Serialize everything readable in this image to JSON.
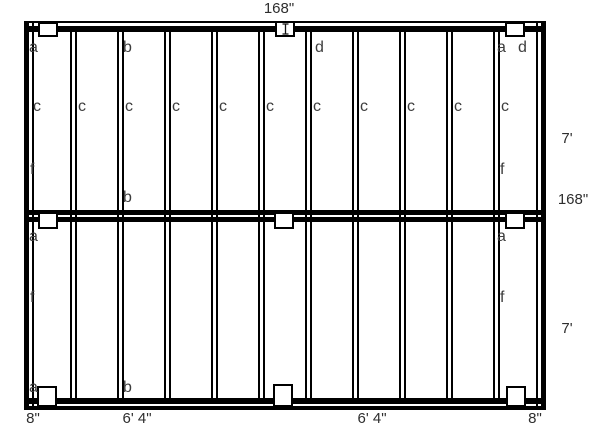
{
  "diagram": {
    "title": "deck framing plan",
    "colors": {
      "background": "#ffffff",
      "line": "#000000",
      "text": "#3d3d3d"
    },
    "frame": {
      "x": 24,
      "y": 21,
      "w": 522,
      "h": 389
    },
    "beams": {
      "top-beam-band": {
        "x": 24,
        "y": 26,
        "w": 522,
        "h": 6
      },
      "mid-beam-upper": {
        "x": 24,
        "y": 210,
        "w": 522,
        "h": 5
      },
      "mid-beam-lower": {
        "x": 24,
        "y": 217,
        "w": 522,
        "h": 5
      },
      "bottom-beam-band": {
        "x": 24,
        "y": 398,
        "w": 522,
        "h": 6
      }
    },
    "inner_lines": {
      "left-rim-inner-line": {
        "x": 32,
        "y": 21,
        "w": 2,
        "h": 389
      },
      "right-rim-inner-line": {
        "x": 536,
        "y": 21,
        "w": 2,
        "h": 389
      }
    },
    "joists": {
      "count": 10,
      "first_center": 73.5,
      "spacing": 47,
      "y": 32,
      "height": 366,
      "width": 7
    },
    "posts": [
      {
        "name": "post-top-left",
        "x": 38,
        "y": 22,
        "w": 20,
        "h": 15
      },
      {
        "name": "post-top-center",
        "x": 275,
        "y": 21,
        "w": 20,
        "h": 16,
        "cursor": true
      },
      {
        "name": "post-top-right",
        "x": 505,
        "y": 22,
        "w": 20,
        "h": 15
      },
      {
        "name": "post-mid-left",
        "x": 38,
        "y": 212,
        "w": 20,
        "h": 17
      },
      {
        "name": "post-mid-center",
        "x": 274,
        "y": 212,
        "w": 20,
        "h": 17
      },
      {
        "name": "post-mid-right",
        "x": 505,
        "y": 212,
        "w": 20,
        "h": 17
      },
      {
        "name": "post-bottom-left",
        "x": 37,
        "y": 386,
        "w": 20,
        "h": 21
      },
      {
        "name": "post-bottom-center",
        "x": 273,
        "y": 384,
        "w": 20,
        "h": 23
      },
      {
        "name": "post-bottom-right",
        "x": 506,
        "y": 386,
        "w": 20,
        "h": 21
      }
    ],
    "member_labels": [
      {
        "text": "a",
        "x": 29,
        "y": 40
      },
      {
        "text": "b",
        "x": 123,
        "y": 40
      },
      {
        "text": "d",
        "x": 315,
        "y": 40
      },
      {
        "text": "a",
        "x": 497,
        "y": 40
      },
      {
        "text": "d",
        "x": 518,
        "y": 40
      },
      {
        "text": "c",
        "x": 33,
        "y": 99
      },
      {
        "text": "c",
        "x": 78,
        "y": 99
      },
      {
        "text": "c",
        "x": 125,
        "y": 99
      },
      {
        "text": "c",
        "x": 172,
        "y": 99
      },
      {
        "text": "c",
        "x": 219,
        "y": 99
      },
      {
        "text": "c",
        "x": 266,
        "y": 99
      },
      {
        "text": "c",
        "x": 313,
        "y": 99
      },
      {
        "text": "c",
        "x": 360,
        "y": 99
      },
      {
        "text": "c",
        "x": 407,
        "y": 99
      },
      {
        "text": "c",
        "x": 454,
        "y": 99
      },
      {
        "text": "c",
        "x": 501,
        "y": 99
      },
      {
        "text": "f",
        "x": 30,
        "y": 162
      },
      {
        "text": "f",
        "x": 500,
        "y": 162
      },
      {
        "text": "b",
        "x": 123,
        "y": 190
      },
      {
        "text": "a",
        "x": 29,
        "y": 229
      },
      {
        "text": "a",
        "x": 497,
        "y": 229
      },
      {
        "text": "f",
        "x": 30,
        "y": 290
      },
      {
        "text": "f",
        "x": 500,
        "y": 290
      },
      {
        "text": "a",
        "x": 29,
        "y": 380
      },
      {
        "text": "b",
        "x": 123,
        "y": 380
      }
    ],
    "dimension_labels": [
      {
        "text": "168\"",
        "cx": 279,
        "y": 1
      },
      {
        "text": "7'",
        "cx": 567,
        "y": 131
      },
      {
        "text": "168\"",
        "cx": 573,
        "y": 192
      },
      {
        "text": "7'",
        "cx": 567,
        "y": 321
      },
      {
        "text": "8\"",
        "cx": 33,
        "y": 411
      },
      {
        "text": "6' 4\"",
        "cx": 137,
        "y": 411
      },
      {
        "text": "6' 4\"",
        "cx": 372,
        "y": 411
      },
      {
        "text": "8\"",
        "cx": 535,
        "y": 411
      }
    ]
  }
}
